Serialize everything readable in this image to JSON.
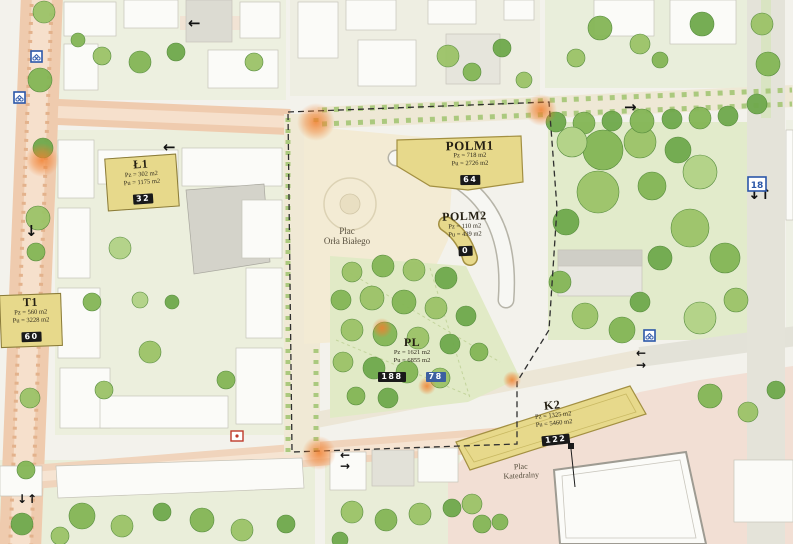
{
  "map_title": "Plac Orła Białego – urban masterplan",
  "palette": {
    "parcel_yellow": "#e7d98b",
    "badge_black": "#191919",
    "badge_blue": "#3c5fa0",
    "sign_blue": "#2b57a8",
    "sign_red": "#bf3a2b",
    "highlight_orange": "#f17f2e",
    "road_salmon": "#efcbae",
    "promenade_cream": "#f0e9d5",
    "plaza_cream": "#f3ebd4",
    "plaza_pink": "#f2dfd4",
    "park_green": "#e2ebcb",
    "tree_green": "#84b656"
  },
  "parcels": [
    {
      "key": "l1",
      "title": "Ł1",
      "line1": "Pz = 302 m2",
      "line2": "Pu = 1175 m2",
      "badges": [
        {
          "text": "32",
          "style": "black"
        }
      ]
    },
    {
      "key": "t1",
      "title": "T1",
      "line1": "Pz = 560 m2",
      "line2": "Pu = 3228 m2",
      "badges": [
        {
          "text": "60",
          "style": "black"
        }
      ]
    },
    {
      "key": "polm1",
      "title": "POLM1",
      "line1": "Pz = 718 m2",
      "line2": "Pu = 2726 m2",
      "badges": [
        {
          "text": "64",
          "style": "black"
        }
      ]
    },
    {
      "key": "polm2",
      "title": "POLM2",
      "line1": "Pz = 110 m2",
      "line2": "Pu = 439 m2",
      "badges": [
        {
          "text": "0",
          "style": "black"
        }
      ]
    },
    {
      "key": "pl",
      "title": "PL",
      "line1": "Pz = 1621 m2",
      "line2": "Pu = 6855 m2",
      "badges": [
        {
          "text": "188",
          "style": "black"
        },
        {
          "text": "78",
          "style": "blue"
        }
      ]
    },
    {
      "key": "k2",
      "title": "K2",
      "line1": "Pz = 1325 m2",
      "line2": "Pu = 5460 m2",
      "badges": [
        {
          "text": "122",
          "style": "black"
        }
      ]
    }
  ],
  "places": [
    {
      "key": "plac-orla-bialego",
      "line1": "Plac",
      "line2": "Orła Białego"
    },
    {
      "key": "plac-katedralny",
      "line1": "Plac",
      "line2": "Katedralny"
    }
  ],
  "signs": {
    "route18": "18"
  }
}
